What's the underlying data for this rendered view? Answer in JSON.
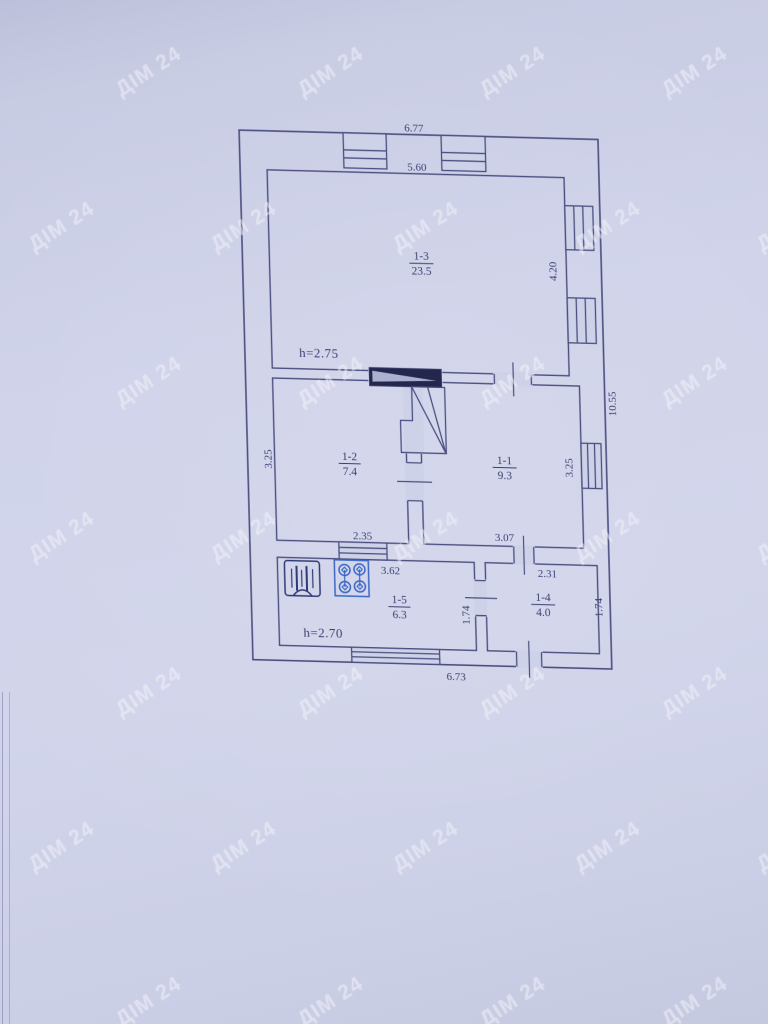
{
  "watermark": {
    "text": "ДІМ 24"
  },
  "plan": {
    "dims": {
      "overall_top": "6.77",
      "room_1_3_width": "5.60",
      "room_1_3_depth": "4.20",
      "overall_right": "10.55",
      "room_1_2_depth": "3.25",
      "room_1_2_width": "2.35",
      "room_1_1_width": "3.07",
      "room_1_1_depth": "3.25",
      "room_1_5_width": "3.62",
      "room_1_4_width": "2.31",
      "room_1_5_depth": "1.74",
      "room_1_4_depth": "1.74",
      "overall_bottom": "6.73"
    },
    "heights": {
      "main": "h=2.75",
      "annex": "h=2.70"
    },
    "rooms": [
      {
        "id": "1-3",
        "area": "23.5"
      },
      {
        "id": "1-2",
        "area": "7.4"
      },
      {
        "id": "1-1",
        "area": "9.3"
      },
      {
        "id": "1-5",
        "area": "6.3"
      },
      {
        "id": "1-4",
        "area": "4.0"
      }
    ],
    "icons": [
      {
        "name": "heater-icon"
      },
      {
        "name": "stove-icon"
      }
    ],
    "colors": {
      "background": "#ced2e8",
      "line": "#4a4f80",
      "text": "#3a3f72",
      "stove_icon": "#3a66c4",
      "heater_icon": "#2e3a75",
      "chimney_fill": "#23264d"
    }
  }
}
